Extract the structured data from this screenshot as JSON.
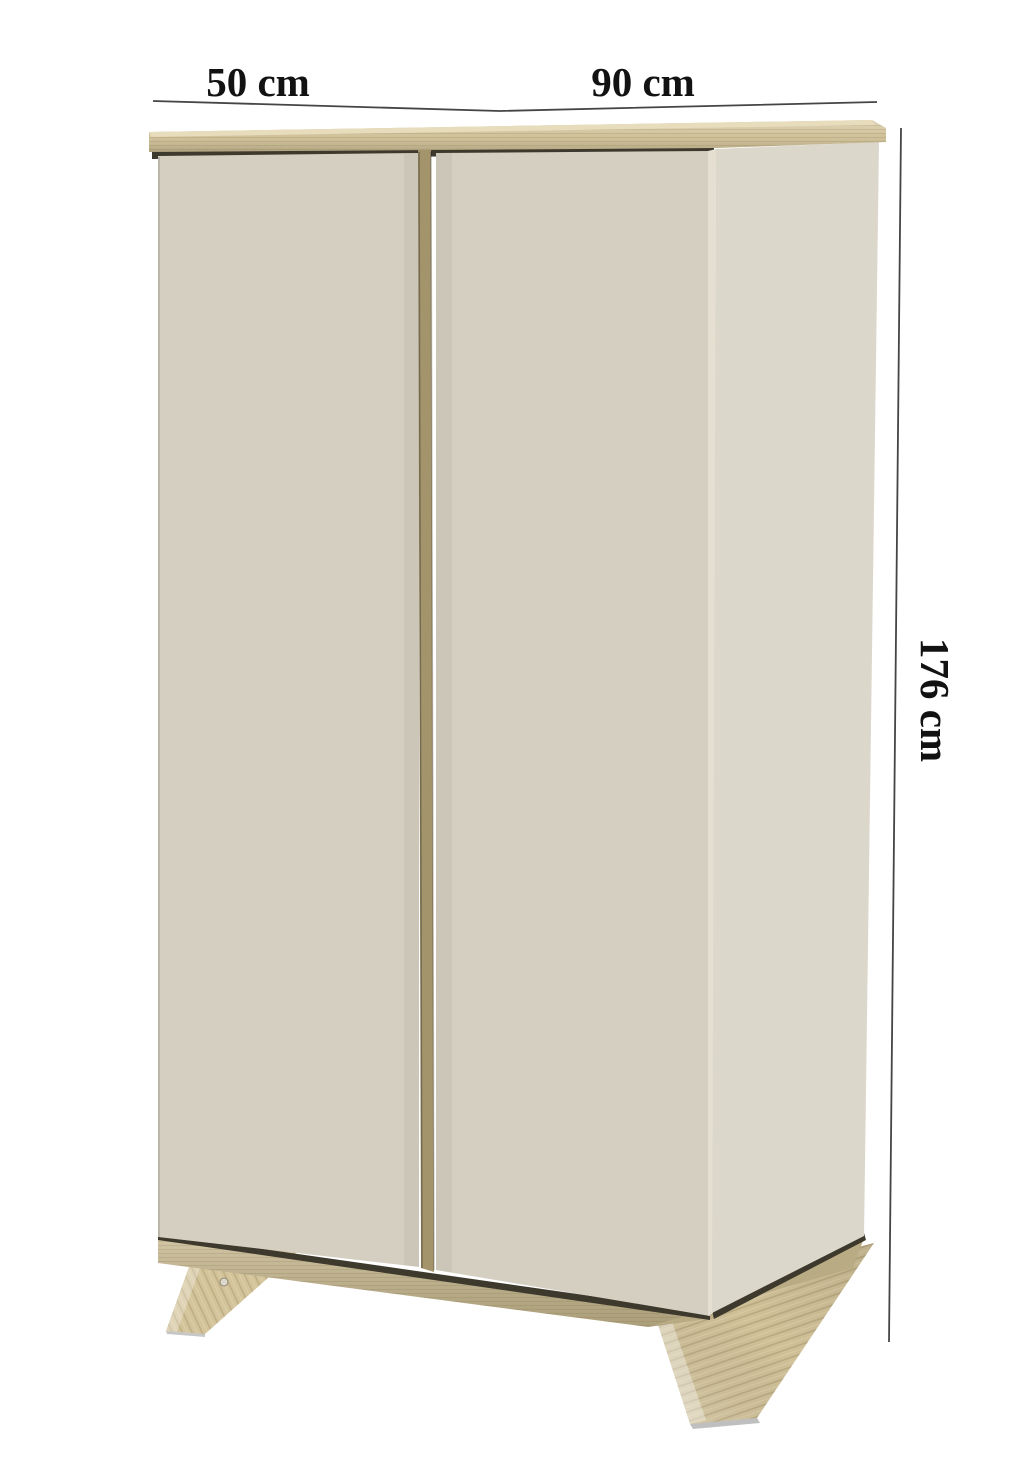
{
  "figure": {
    "title": "wardrobe dimension diagram",
    "product": "two-door wardrobe with wooden top panel and angled wooden legs",
    "labels": {
      "depth": "50 cm",
      "width": "90 cm",
      "height": "176 cm"
    },
    "colors": {
      "background": "#ffffff",
      "door": "#d5cfc1",
      "side_panel": "#d8d3c6",
      "edge_highlight": "#e4dfd1",
      "top_wood": "#cfc096",
      "top_wood_light": "#e7dcbb",
      "base_wood": "#c8b98f",
      "leg_wood": "#d3c49b",
      "divider_wood": "#a3946c",
      "shadow": "#3e392d",
      "dimension_line": "#454545",
      "text": "#121212"
    }
  }
}
